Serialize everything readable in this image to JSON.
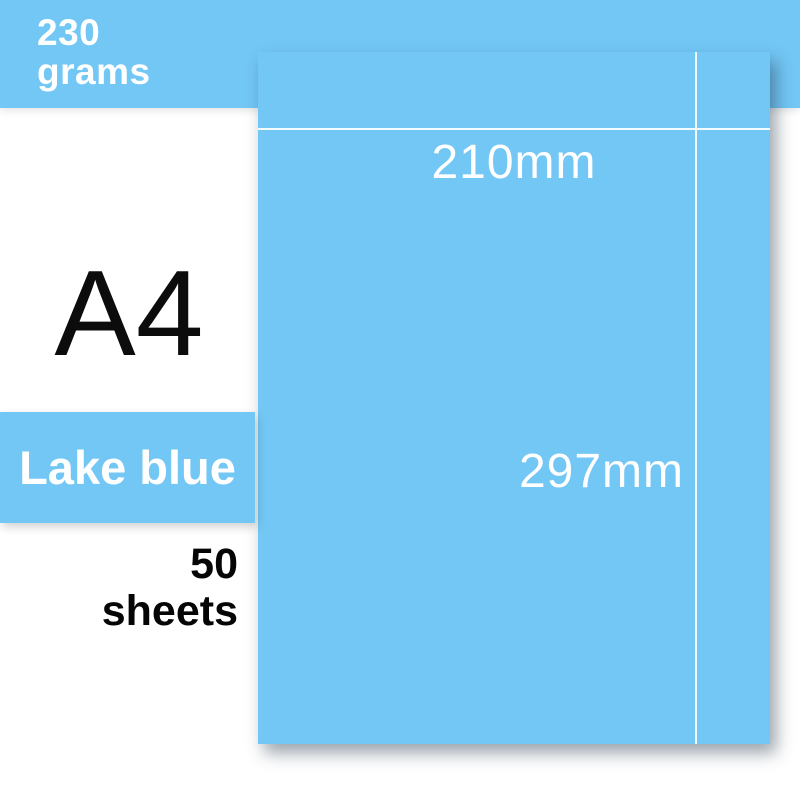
{
  "banner": {
    "weight_value": "230",
    "weight_unit": "grams"
  },
  "left_panel": {
    "size_label": "A4",
    "color_badge_label": "Lake blue",
    "count_value": "50",
    "count_unit": "sheets"
  },
  "paper": {
    "width_label": "210mm",
    "height_label": "297mm"
  },
  "colors": {
    "accent_blue": "#73c7f5",
    "guide_line_white": "#ffffff",
    "text_black": "#0c0c0c",
    "text_white": "#ffffff"
  }
}
